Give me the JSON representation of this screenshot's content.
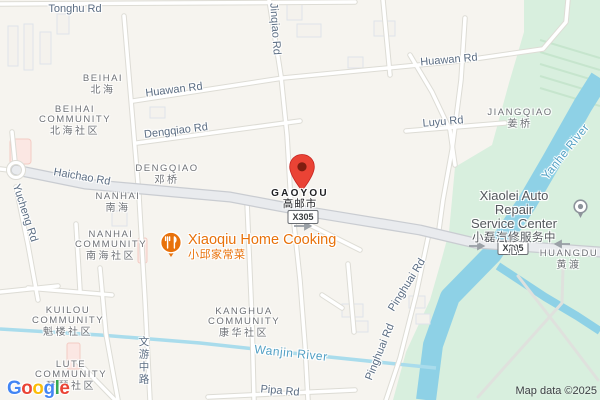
{
  "map": {
    "attribution": "Map data ©2025",
    "logo": {
      "letters": [
        "G",
        "o",
        "o",
        "g",
        "l",
        "e"
      ]
    },
    "shield": "X305",
    "marker": {
      "title": "GAOYOU",
      "subtitle": "高邮市"
    },
    "road_labels": {
      "tonghu": "Tonghu Rd",
      "jinqiao": "Jinqiao Rd",
      "huawan_west": "Huawan Rd",
      "huawan_east": "Huawan Rd",
      "dengqiao": "Dengqiao Rd",
      "luyu": "Luyu Rd",
      "haichao": "Haichao Rd",
      "yucheng": "Yucheng Rd",
      "wenyou": "文游中路",
      "pipa": "Pipa Rd",
      "pinghuai_south": "Pinghuai Rd",
      "pinghuai_north": "Pinghuai Rd"
    },
    "water_labels": {
      "wanjin": "Wanjin River",
      "yanhe": "Yanhe River"
    },
    "localities": {
      "beihai": {
        "en": "BEIHAI",
        "zh": "北海"
      },
      "beihai_community": {
        "en1": "BEIHAI",
        "en2": "COMMUNITY",
        "zh": "北海社区"
      },
      "dengqiao": {
        "en": "DENGQIAO",
        "zh": "邓桥"
      },
      "nanhai": {
        "en": "NANHAI",
        "zh": "南海"
      },
      "nanhai_community": {
        "en1": "NANHAI",
        "en2": "COMMUNITY",
        "zh": "南海社区"
      },
      "jiangqiao": {
        "en": "JIANGQIAO",
        "zh": "姜桥"
      },
      "huangdu": {
        "en": "HUANGDU",
        "zh": "黄渡"
      },
      "kuilou_community": {
        "en1": "KUILOU",
        "en2": "COMMUNITY",
        "zh": "魁楼社区"
      },
      "lute_community": {
        "en1": "LUTE",
        "en2": "COMMUNITY",
        "zh": "琵琶社区"
      },
      "kanghua_community": {
        "en1": "KANGHUA",
        "en2": "COMMUNITY",
        "zh": "康华社区"
      }
    },
    "pois": {
      "xiaoqiu": {
        "en": "Xiaoqiu Home Cooking",
        "zh": "小邱家常菜"
      },
      "xiaolei": {
        "line1": "Xiaolei Auto Repair",
        "line2": "Service Center",
        "zh": "小磊汽修服务中心"
      }
    },
    "colors": {
      "pin_red": "#EA4335",
      "poi_orange": "#E8710A",
      "water": "#92D3E8",
      "park_green": "#D8EFDE",
      "logo": [
        "#4285F4",
        "#EA4335",
        "#FBBC05",
        "#4285F4",
        "#34A853",
        "#EA4335"
      ]
    }
  }
}
